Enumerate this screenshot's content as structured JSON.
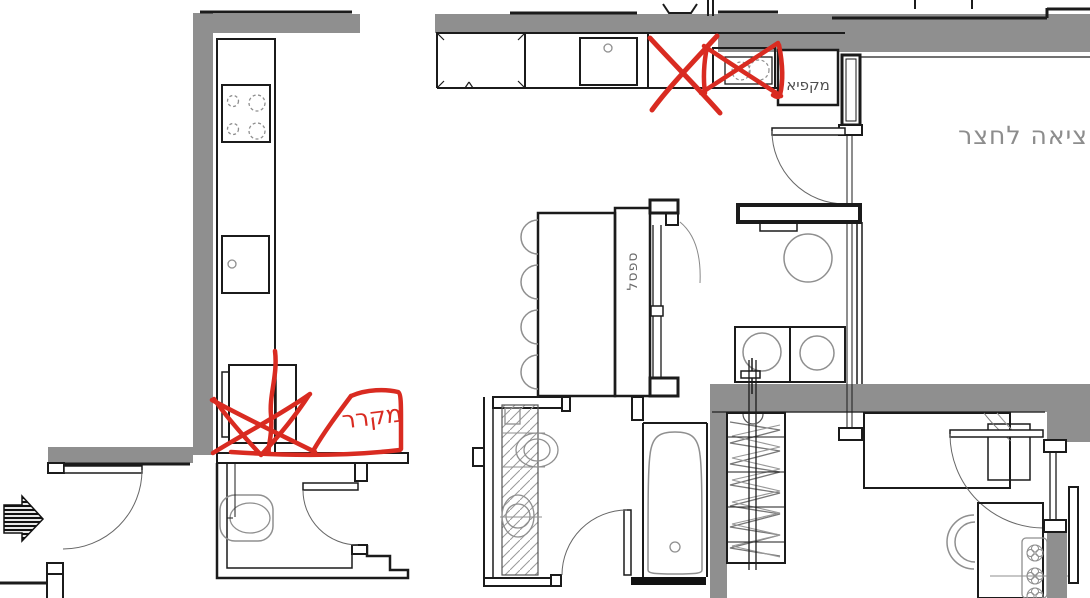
{
  "drawing": {
    "annotations": {
      "fridge_label": "מקרר",
      "freezer_label": "מקפיא",
      "bench_label": "ספסל",
      "yard_exit_label": "ציאה לחצר"
    },
    "colors": {
      "wall_gray": "#8f8f8f",
      "line_black": "#1b1b1b",
      "fixture_gray": "#8f8f8f",
      "annotation_red": "#d92b21",
      "text_gray": "#8d8d8d",
      "label_dark": "#4f4f4f"
    }
  }
}
